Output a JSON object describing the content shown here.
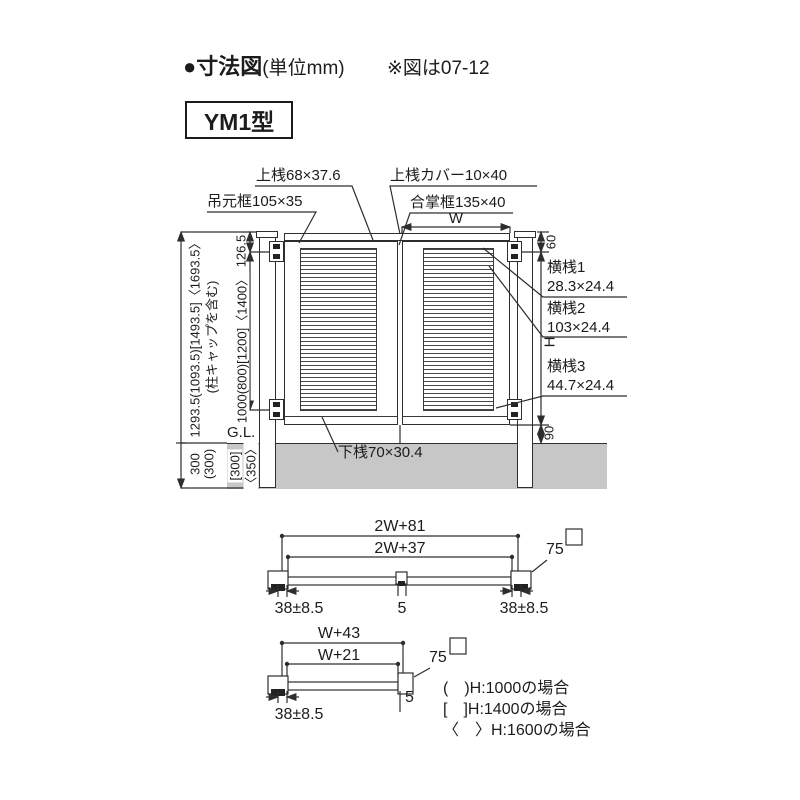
{
  "header": {
    "bullet_title": "●寸法図",
    "unit_note": "(単位mm)",
    "ref_note": "※図は07-12",
    "model": "YM1型"
  },
  "front_view": {
    "top_labels": {
      "top_rail": "上桟68×37.6",
      "hinge_stile": "吊元框105×35",
      "top_rail_cover": "上桟カバー10×40",
      "meeting_stile": "合掌框135×40",
      "leaf_width": "W"
    },
    "left_labels": {
      "overall_height": "1293.5(1093.5)[1493.5]〈1693.5〉",
      "overall_height_note": "(柱キャップを含む)",
      "top_offset": "126.5",
      "hinge_pitch": "1000(800)[1200]〈1400〉",
      "ground_line": "G.L.",
      "embed_depth": "300",
      "embed_depth_paren": "(300)",
      "embed_depth_bracket": "[300]",
      "embed_depth_angle": "〈350〉"
    },
    "right_labels": {
      "top_gap": "60",
      "crossbar1_name": "横桟1",
      "crossbar1_size": "28.3×24.4",
      "crossbar2_name": "横桟2",
      "crossbar2_size": "103×24.4",
      "gate_height": "H",
      "crossbar3_name": "横桟3",
      "crossbar3_size": "44.7×24.4",
      "bottom_gap": "90"
    },
    "bottom_labels": {
      "bottom_rail": "下桟70×30.4"
    }
  },
  "section_double_gate": {
    "outer_width": "2W+81",
    "inner_width": "2W+37",
    "post_size": "75",
    "left_offset": "38±8.5",
    "center_gap": "5",
    "right_offset": "38±8.5"
  },
  "section_single_gate": {
    "outer_width": "W+43",
    "inner_width": "W+21",
    "post_size": "75",
    "left_offset": "38±8.5",
    "edge_gap": "5"
  },
  "legend": {
    "items": [
      "(　)H:1000の場合",
      "[　]H:1400の場合",
      "〈　〉H:1600の場合"
    ]
  },
  "colors": {
    "line": "#2e2e2e",
    "ground_fill": "#c7c7c7"
  }
}
